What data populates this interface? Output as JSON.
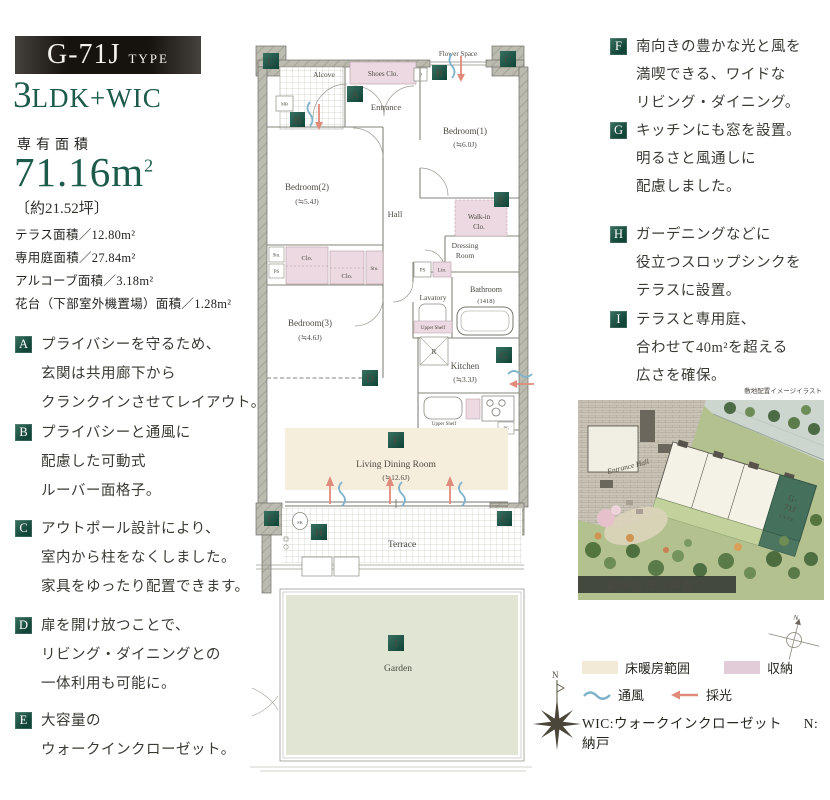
{
  "header": {
    "type_code": "G-71J",
    "type_word": "TYPE",
    "layout_big": "3",
    "layout_rest": "LDK+WIC"
  },
  "area": {
    "heading": "専有面積",
    "value": "71.16m",
    "sup": "2",
    "tsubo": "〔約21.52坪〕",
    "details": [
      "テラス面積／12.80m²",
      "専用庭面積／27.84m²",
      "アルコーブ面積／3.18m²",
      "花台（下部室外機置場）面積／1.28m²"
    ]
  },
  "features_left": [
    {
      "letter": "A",
      "lines": [
        "プライバシーを守るため、",
        "玄関は共用廊下から",
        "クランクインさせてレイアウト。"
      ]
    },
    {
      "letter": "B",
      "lines": [
        "プライバシーと通風に",
        "配慮した可動式",
        "ルーバー面格子。"
      ]
    },
    {
      "letter": "C",
      "lines": [
        "アウトポール設計により、",
        "室内から柱をなくしました。",
        "家具をゆったり配置できます。"
      ]
    },
    {
      "letter": "D",
      "lines": [
        "扉を開け放つことで、",
        "リビング・ダイニングとの",
        "一体利用も可能に。"
      ]
    },
    {
      "letter": "E",
      "lines": [
        "大容量の",
        "ウォークインクローゼット。"
      ]
    }
  ],
  "features_right": [
    {
      "letter": "F",
      "lines": [
        "南向きの豊かな光と風を",
        "満喫できる、ワイドな",
        "リビング・ダイニング。"
      ]
    },
    {
      "letter": "G",
      "lines": [
        "キッチンにも窓を設置。",
        "明るさと風通しに",
        "配慮しました。"
      ]
    },
    {
      "letter": "H",
      "lines": [
        "ガーデニングなどに",
        "役立つスロップシンクを",
        "テラスに設置。"
      ]
    },
    {
      "letter": "I",
      "lines": [
        "テラスと専用庭、",
        "合わせて40m²を超える",
        "広さを確保。"
      ]
    }
  ],
  "plan": {
    "flower_space": "Flower Space",
    "alcove": "Alcove",
    "mb": "MB",
    "shoes_clo": "Shoes Clo.",
    "p": "P",
    "entrance": "Entrance",
    "bedroom1": "Bedroom(1)",
    "bedroom1_size": "(≒6.0J)",
    "bedroom2": "Bedroom(2)",
    "bedroom2_size": "(≒5.4J)",
    "bedroom3": "Bedroom(3)",
    "bedroom3_size": "(≒4.6J)",
    "hall": "Hall",
    "walkin1": "Walk-in",
    "walkin2": "Clo.",
    "dressing1": "Dressing",
    "dressing2": "Room",
    "sto": "Sto.",
    "clo": "Clo.",
    "ps": "PS",
    "lin": "Lin.",
    "bathroom": "Bathroom",
    "bathroom_size": "(1418)",
    "lavatory": "Lavatory",
    "upper_shelf": "Upper Shelf",
    "fridge": "R",
    "kitchen": "Kitchen",
    "kitchen_size": "(≒3.3J)",
    "ldr": "Living Dining Room",
    "ldr_size": "(≒12.6J)",
    "terrace": "Terrace",
    "garden": "Garden",
    "sk": "SK",
    "north": "N"
  },
  "sitemap": {
    "caption": "敷地配置イメージイラスト",
    "hall": "Entrance Hall",
    "unit_line1": "G-",
    "unit_line2": "71J",
    "unit_line3": "TYPE",
    "banner": "観桜の沢（中庭）"
  },
  "legend": {
    "floor_heating": "床暖房範囲",
    "storage": "収納",
    "ventilation": "通風",
    "daylight": "採光",
    "wic_note": "WIC:ウォークインクローゼット",
    "n_note": "N:納戸"
  },
  "colors": {
    "accent_green": "#1c5a4b",
    "badge_green": "#114538",
    "storage_pink": "#ecd9e1",
    "floor_heating_beige": "#f5eedd",
    "garden_green": "#e0e6d3",
    "wall_gray": "#b9b9ad",
    "ventilation_blue": "#7fb3cb",
    "daylight_red": "#e08b7a"
  }
}
